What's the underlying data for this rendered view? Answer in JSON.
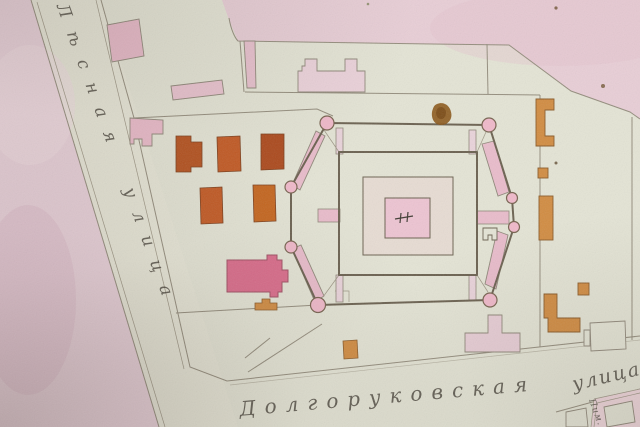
{
  "labels": {
    "street_left": "Лѣсная улица",
    "street_bottom": "Долгоруковская",
    "street_bottom_2": "улица",
    "corner_partial": "Пим."
  },
  "colors": {
    "paper": "#e4e4d5",
    "street": "#e7e6d7",
    "block_pink_left": "#e9d1da",
    "block_pink_topright": "#e8ced6",
    "block_pink_corner": "#eed5da",
    "building_pink": "#e9bccb",
    "building_pale_pink": "#ebd2da",
    "church_magenta": "#da6c8b",
    "building_red": "#b5521f",
    "building_red2": "#c35a24",
    "building_orange": "#d18c42",
    "tower_pink": "#f0b9ca",
    "ring_pink": "#e9bccb",
    "courtyard": "#e7dcd3",
    "center_pink": "#edc4d2",
    "wall": "#6b6150",
    "line": "#948d7d",
    "ink": "#49443b",
    "stain": "#8a5517"
  }
}
